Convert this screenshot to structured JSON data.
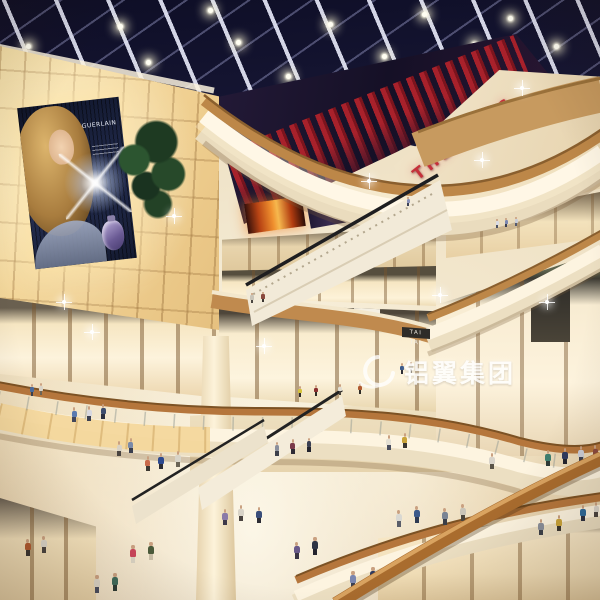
{
  "title": "Multi-level shopping mall atrium — architectural rendering",
  "signs": {
    "theatres": "THEATRES",
    "store": "TAI TAI",
    "billboard_brand": "GUERLAIN"
  },
  "watermark": {
    "logo": "swirl-ring",
    "text": "铝翼集团"
  },
  "palette": {
    "ceiling_dark": "#0e0e26",
    "ceiling_mid": "#34345c",
    "mullion": "#e4e6f6",
    "theatres_red": "#c5303a",
    "fin_red": "#a8212b",
    "fin_red_dark": "#7c141d",
    "fascia_bright": "#fff7e6",
    "fascia_cream": "#ecdfc2",
    "wood_rail": "#bd8748",
    "wall_glow": "#f8e3ab",
    "floor": "#efe2c6",
    "screen_fire": "#ef8f2e",
    "interior_warm": "#fdf3dc",
    "fascia_green": "#5e644e",
    "handrail_wood": "#a96c2e"
  },
  "ceiling": {
    "lights": [
      [
        58,
        80
      ],
      [
        146,
        60
      ],
      [
        236,
        40
      ],
      [
        328,
        22
      ],
      [
        422,
        12
      ],
      [
        508,
        16
      ],
      [
        96,
        110
      ],
      [
        190,
        94
      ],
      [
        286,
        74
      ],
      [
        382,
        54
      ],
      [
        472,
        42
      ],
      [
        554,
        44
      ],
      [
        26,
        44
      ],
      [
        118,
        24
      ],
      [
        208,
        8
      ]
    ]
  },
  "sparkles": [
    [
      172,
      214
    ],
    [
      367,
      179
    ],
    [
      480,
      158
    ],
    [
      62,
      300
    ],
    [
      545,
      300
    ],
    [
      262,
      344
    ],
    [
      90,
      330
    ],
    [
      520,
      86
    ],
    [
      438,
      293
    ]
  ],
  "people": [
    [
      497,
      228,
      9,
      "#d9dbe4",
      "#4a4f62"
    ],
    [
      506,
      227,
      9,
      "#7a86b0",
      "#3a3f52"
    ],
    [
      516,
      226,
      9,
      "#c9cdd8",
      "#555a6e"
    ],
    [
      408,
      206,
      9,
      "#8a92b8",
      "#3c4154"
    ],
    [
      252,
      303,
      10,
      "#c9c4b8",
      "#4a4540"
    ],
    [
      263,
      302,
      10,
      "#8a4a3f",
      "#3a3530"
    ],
    [
      300,
      397,
      11,
      "#d4c23a",
      "#2e2a24"
    ],
    [
      316,
      396,
      11,
      "#8a2f2f",
      "#2e2a24"
    ],
    [
      340,
      395,
      11,
      "#e2ded2",
      "#4a443c"
    ],
    [
      360,
      394,
      11,
      "#b05a30",
      "#2e2a24"
    ],
    [
      402,
      374,
      11,
      "#3a5a8a",
      "#2c2c34"
    ],
    [
      411,
      373,
      11,
      "#c9c2b2",
      "#5a5244"
    ],
    [
      32,
      396,
      12,
      "#4a6a9a",
      "#3a3f4e"
    ],
    [
      41,
      395,
      12,
      "#d9d4c8",
      "#6b6456"
    ],
    [
      74,
      422,
      15,
      "#5a7ab0",
      "#42465a"
    ],
    [
      89,
      421,
      15,
      "#d8d8e0",
      "#3c4052"
    ],
    [
      103,
      419,
      15,
      "#3f4e6e",
      "#2c3040"
    ],
    [
      119,
      456,
      15,
      "#d9d2c4",
      "#4a4440"
    ],
    [
      131,
      453,
      15,
      "#7a8aa8",
      "#3a3e4e"
    ],
    [
      148,
      471,
      15,
      "#c96a4a",
      "#3c3832"
    ],
    [
      161,
      469,
      16,
      "#2e4a8f",
      "#2c2c34"
    ],
    [
      178,
      467,
      16,
      "#d8d4c8",
      "#6b6456"
    ],
    [
      277,
      456,
      14,
      "#8a8f9c",
      "#3c3f4a"
    ],
    [
      293,
      454,
      15,
      "#7a3a4a",
      "#2e2a34"
    ],
    [
      309,
      452,
      14,
      "#3a3f52",
      "#23242e"
    ],
    [
      389,
      450,
      15,
      "#e4e0d4",
      "#4a4e5e"
    ],
    [
      405,
      448,
      15,
      "#caa43a",
      "#3a3630"
    ],
    [
      492,
      469,
      16,
      "#d9d4ca",
      "#5a5448"
    ],
    [
      548,
      466,
      16,
      "#3f7f6f",
      "#2e3a36"
    ],
    [
      565,
      464,
      16,
      "#2e3a5f",
      "#23242e"
    ],
    [
      581,
      462,
      16,
      "#caccd6",
      "#3c4052"
    ],
    [
      595,
      460,
      15,
      "#8a4a3f",
      "#2e2a24"
    ],
    [
      133,
      563,
      18,
      "#c9455a",
      "#d9d2c2"
    ],
    [
      151,
      560,
      18,
      "#4a5a3a",
      "#cabfa8"
    ],
    [
      225,
      525,
      16,
      "#8a7aa8",
      "#3c3848"
    ],
    [
      241,
      521,
      16,
      "#d9d4c8",
      "#4a4440"
    ],
    [
      259,
      523,
      16,
      "#3a4e7a",
      "#2c2c34"
    ],
    [
      297,
      559,
      17,
      "#6a5a8a",
      "#3a3444"
    ],
    [
      315,
      555,
      18,
      "#2e3444",
      "#23242e"
    ],
    [
      399,
      527,
      17,
      "#d9d8d2",
      "#5a5e6a"
    ],
    [
      417,
      523,
      17,
      "#3c5a8a",
      "#2e3a52"
    ],
    [
      445,
      525,
      17,
      "#7a8494",
      "#3a3e48"
    ],
    [
      463,
      521,
      17,
      "#c9c4b8",
      "#4a443c"
    ],
    [
      541,
      535,
      16,
      "#8a8f9a",
      "#3c4048"
    ],
    [
      559,
      531,
      16,
      "#caa43a",
      "#3a3630"
    ],
    [
      97,
      593,
      18,
      "#d9d2c4",
      "#4a4e5e"
    ],
    [
      115,
      591,
      18,
      "#3f6a5a",
      "#2c3a34"
    ],
    [
      353,
      589,
      18,
      "#7a86b0",
      "#3a3f52"
    ],
    [
      373,
      585,
      18,
      "#2e3a5f",
      "#cabfa8"
    ],
    [
      583,
      521,
      16,
      "#2e6a9a",
      "#2c3040"
    ],
    [
      596,
      517,
      15,
      "#d9d4ca",
      "#4a4440"
    ],
    [
      28,
      556,
      17,
      "#b05a30",
      "#3a3530"
    ],
    [
      44,
      553,
      17,
      "#d9d4c8",
      "#4a4440"
    ]
  ]
}
